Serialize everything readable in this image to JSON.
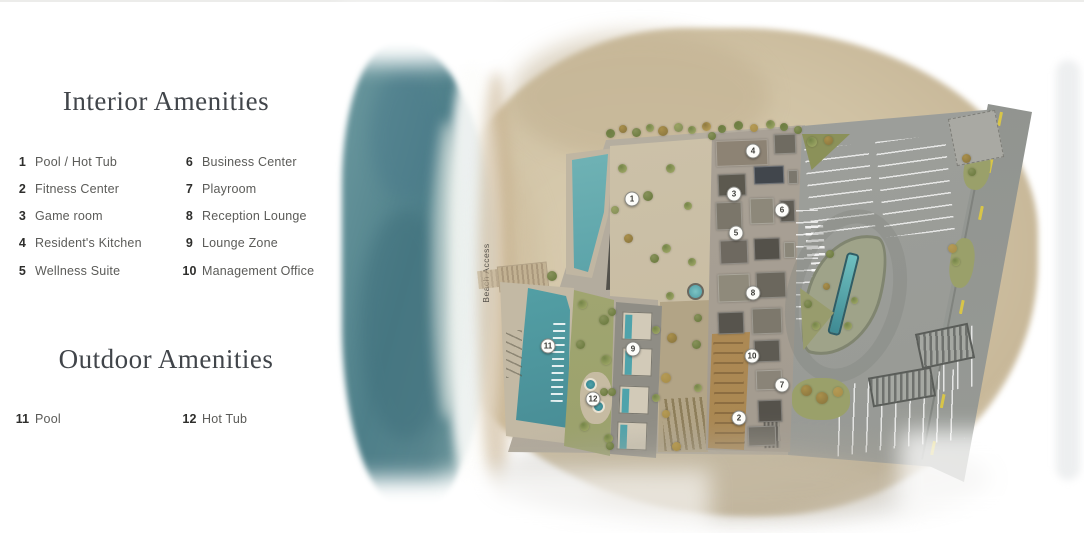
{
  "legend": {
    "interior": {
      "title": "Interior Amenities",
      "items": [
        {
          "num": "1",
          "label": "Pool / Hot Tub"
        },
        {
          "num": "2",
          "label": "Fitness Center"
        },
        {
          "num": "3",
          "label": "Game room"
        },
        {
          "num": "4",
          "label": "Resident's Kitchen"
        },
        {
          "num": "5",
          "label": "Wellness Suite"
        },
        {
          "num": "6",
          "label": "Business Center"
        },
        {
          "num": "7",
          "label": "Playroom"
        },
        {
          "num": "8",
          "label": "Reception Lounge"
        },
        {
          "num": "9",
          "label": "Lounge Zone"
        },
        {
          "num": "10",
          "label": "Management Office"
        }
      ]
    },
    "outdoor": {
      "title": "Outdoor Amenities",
      "items": [
        {
          "num": "11",
          "label": "Pool"
        },
        {
          "num": "12",
          "label": "Hot Tub"
        }
      ]
    }
  },
  "map": {
    "beach_access_label": "Beach Access",
    "markers": [
      {
        "num": "1",
        "x": 272,
        "y": 199
      },
      {
        "num": "2",
        "x": 379,
        "y": 418
      },
      {
        "num": "3",
        "x": 374,
        "y": 194
      },
      {
        "num": "4",
        "x": 393,
        "y": 151
      },
      {
        "num": "5",
        "x": 376,
        "y": 233
      },
      {
        "num": "6",
        "x": 422,
        "y": 210
      },
      {
        "num": "7",
        "x": 422,
        "y": 385
      },
      {
        "num": "8",
        "x": 393,
        "y": 293
      },
      {
        "num": "9",
        "x": 273,
        "y": 349
      },
      {
        "num": "10",
        "x": 392,
        "y": 356
      },
      {
        "num": "11",
        "x": 188,
        "y": 346
      },
      {
        "num": "12",
        "x": 233,
        "y": 399
      }
    ]
  },
  "colors": {
    "ocean": "#4e7f89",
    "foam": "#fdfdfb",
    "sand": "#d0c2a4",
    "pool_water": "#55a3a8",
    "building": "#aca499",
    "asphalt": "#9a9c98",
    "road_line": "#d8c548",
    "greenery": "#87915a",
    "title_text": "#41454a",
    "body_text": "#5b5b58"
  }
}
